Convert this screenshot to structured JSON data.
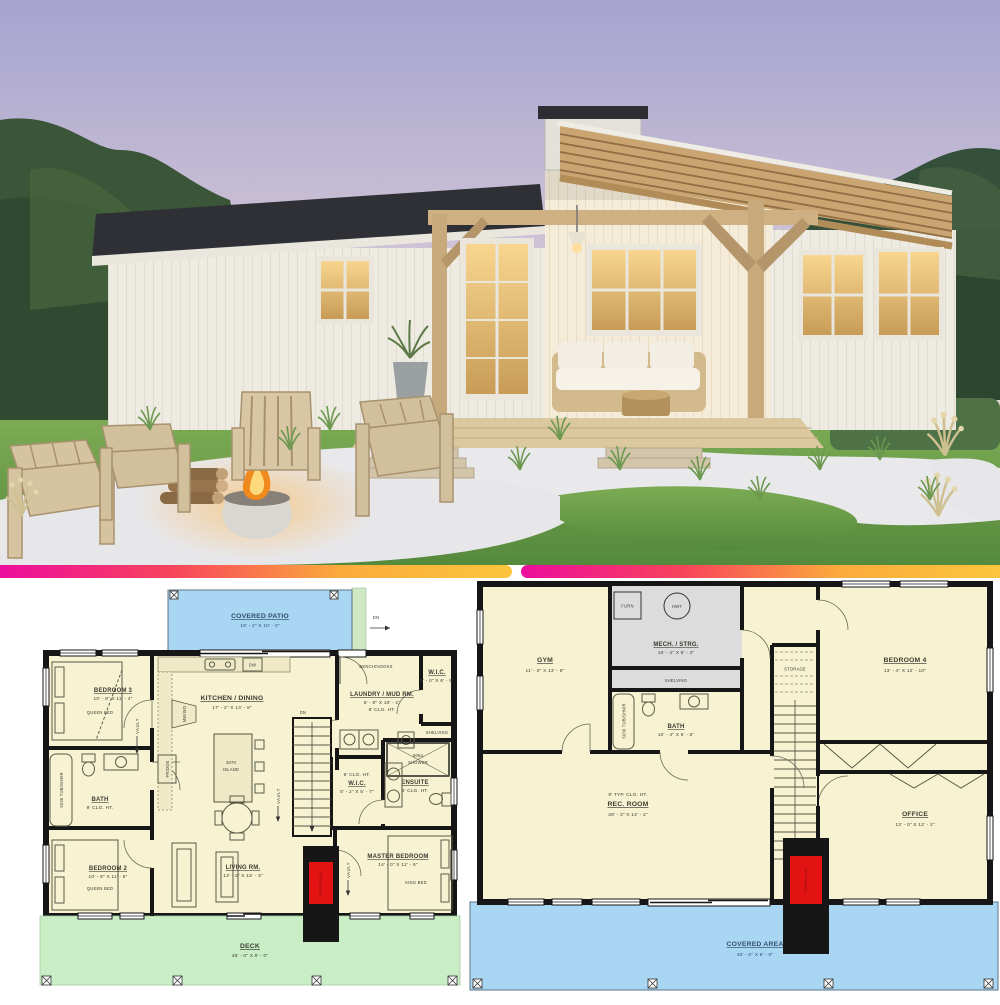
{
  "divider": {
    "gradient_from": "#ec0d9d",
    "gradient_to": "#fcc53d"
  },
  "colors": {
    "plan_floor": "#f7f3d2",
    "plan_wall": "#161616",
    "patio_blue": "#a9d6f2",
    "deck_green": "#c9eec6",
    "mech_gray": "#dcdcdc",
    "fireplace_red": "#e31313",
    "sky_top": "#a9a9d4",
    "lawn_green": "#69a04b",
    "gravel_white": "#e9e9ec",
    "wood_tan": "#c9a571"
  },
  "plan_main": {
    "covered_patio": {
      "name": "COVERED PATIO",
      "dims": "19' - 2\" X 10' - 0\""
    },
    "patio_dn": "DN",
    "bedroom3": {
      "name": "BEDROOM 3",
      "dims": "10' - 8\" X 11' - 4\"",
      "furniture": "QUEEN BED"
    },
    "vault": "VAULT",
    "kitchen": {
      "name": "KITCHEN / DINING",
      "dims": "17' - 2\" X 13' - 9\""
    },
    "island": {
      "line1": "3070",
      "line2": "ISLAND"
    },
    "dw": "DW",
    "fridge": "FRIDGE",
    "oven": "MW/WO",
    "stairs_dn": "DN",
    "laundry": {
      "name": "LAUNDRY / MUD RM.",
      "dims": "8' - 8\" X 10' - 1\"",
      "clg": "8' CLG. HT."
    },
    "bench": "BENCH/HOOKS",
    "wic_top": {
      "name": "W.I.C.",
      "dims": "5' - 0\" X 6' - 9\""
    },
    "shelving": "SHELVING",
    "shower": {
      "line1": "6054",
      "line2": "SHOWER"
    },
    "ensuite": {
      "name": "ENSUITE",
      "clg": "9' CLG. HT."
    },
    "wic_master": {
      "clg": "9' CLG. HT.",
      "name": "W.I.C.",
      "dims": "5' - 2\" X 5' - 7\""
    },
    "bath": {
      "name": "BATH",
      "clg": "9' CLG. HT."
    },
    "tub": "5036 TUB/SHWR",
    "bedroom2": {
      "name": "BEDROOM 2",
      "dims": "10' - 8\" X 11' - 6\"",
      "furniture": "QUEEN BED"
    },
    "living": {
      "name": "LIVING RM.",
      "dims": "13' - 2\" X 15' - 3\""
    },
    "master": {
      "name": "MASTER BEDROOM",
      "dims": "14' - 0\" X 12' - 6\"",
      "furniture": "KING BED"
    },
    "deck": {
      "name": "DECK",
      "dims": "46' - 0\" X 8' - 0\""
    },
    "fireplace": "FIREPLACE"
  },
  "plan_lower": {
    "gym": {
      "name": "GYM",
      "dims": "11' - 0\" X 13' - 8\""
    },
    "mech": {
      "name": "MECH. / STRG.",
      "dims": "10' - 4\" X 8' - 4\"",
      "furn": "FURN",
      "hwt": "HWT",
      "shelving": "SHELVING"
    },
    "storage": "STORAGE",
    "stairs_up": "UP",
    "bedroom4": {
      "name": "BEDROOM 4",
      "dims": "13' - 4\" X 12' - 10\""
    },
    "bath": {
      "name": "BATH",
      "dims": "10' - 4\" X 5' - 6\"",
      "tub": "5036 TUB/SHWR"
    },
    "rec": {
      "clg": "9' TYP. CLG. HT.",
      "name": "REC. ROOM",
      "dims": "28' - 3\" X 14' - 2\""
    },
    "office": {
      "name": "OFFICE",
      "dims": "13' - 0\" X 12' - 2\""
    },
    "covered_area": {
      "name": "COVERED AREA",
      "dims": "46' - 0\" X 8' - 0\""
    },
    "fireplace": "FIREPLACE"
  }
}
